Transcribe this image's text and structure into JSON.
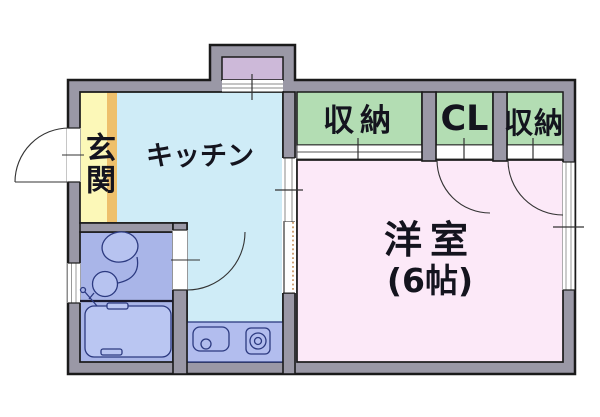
{
  "plan": {
    "rooms": {
      "genkan": "玄関",
      "kitchen": "キッチン",
      "storage_left": "収納",
      "closet": "CL",
      "storage_right": "収納",
      "western_room": "洋室",
      "western_room_size": "(6帖)"
    },
    "fixtures": [
      "toilet",
      "hand-basin",
      "bath-faucet",
      "bathtub",
      "kitchen-sink",
      "stove-burner"
    ],
    "colors": {
      "wall": "#9a98a6",
      "outline": "#1a1a1a",
      "genkan": "#fcf8b8",
      "genkan_step": "#eec06c",
      "kitchen": "#cfecf7",
      "alcove": "#cdb9d9",
      "storage": "#b3ddb3",
      "western_room": "#fce9f8",
      "bathroom": "#a9b5e8",
      "bathtub": "#bac6f2",
      "counter": "#b2bdee",
      "fixture_fill": "#b7c3f0",
      "fixture_line": "#2c3a80"
    }
  }
}
